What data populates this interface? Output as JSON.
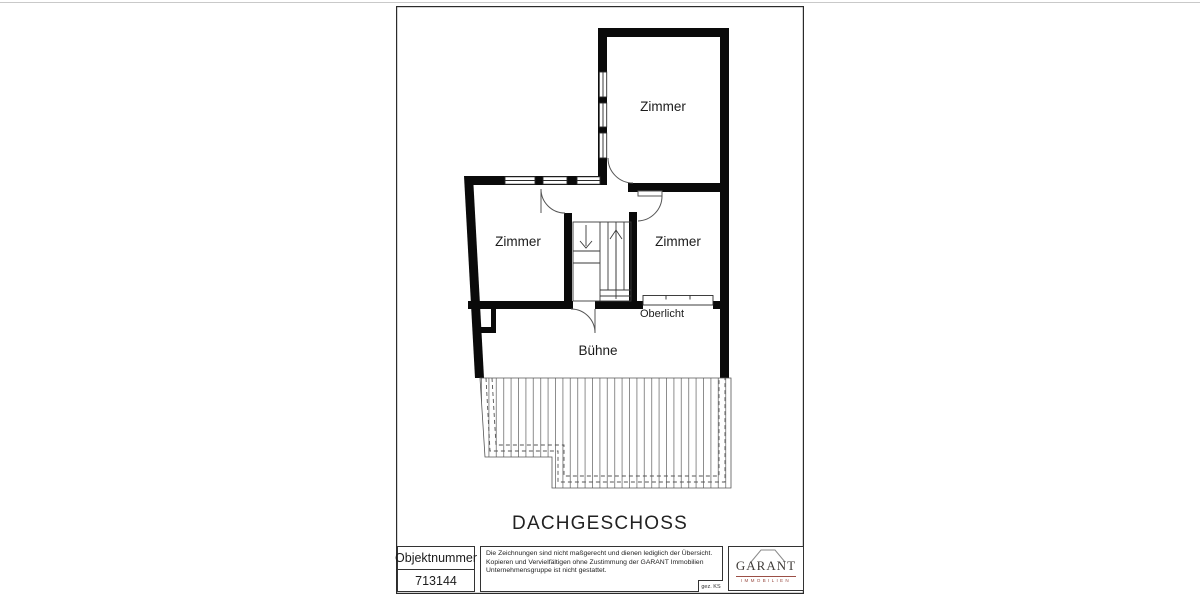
{
  "plan": {
    "room_top": "Zimmer",
    "room_left": "Zimmer",
    "room_right": "Zimmer",
    "room_buehne": "Bühne",
    "skylight_label": "Oberlicht",
    "floor_title": "DACHGESCHOSS"
  },
  "title_block": {
    "object_number_label": "Objektnummer",
    "object_number_value": "713144",
    "disclaimer_lines": [
      "Die Zeichnungen sind nicht maßgerecht und dienen lediglich der Übersicht.",
      "Kopieren und Vervielfältigen ohne Zustimmung der GARANT Immobilien",
      "Unternehmensgruppe ist nicht gestattet."
    ],
    "drawn_by": "gez. KS",
    "logo_name": "GARANT",
    "logo_subtitle": "IMMOBILIEN"
  },
  "colors": {
    "wall": "#0a0a0a",
    "thin_line": "#444444",
    "hatch_line": "#8c8c8c",
    "logo_text": "#403c39",
    "logo_accent": "#9b4f46"
  }
}
